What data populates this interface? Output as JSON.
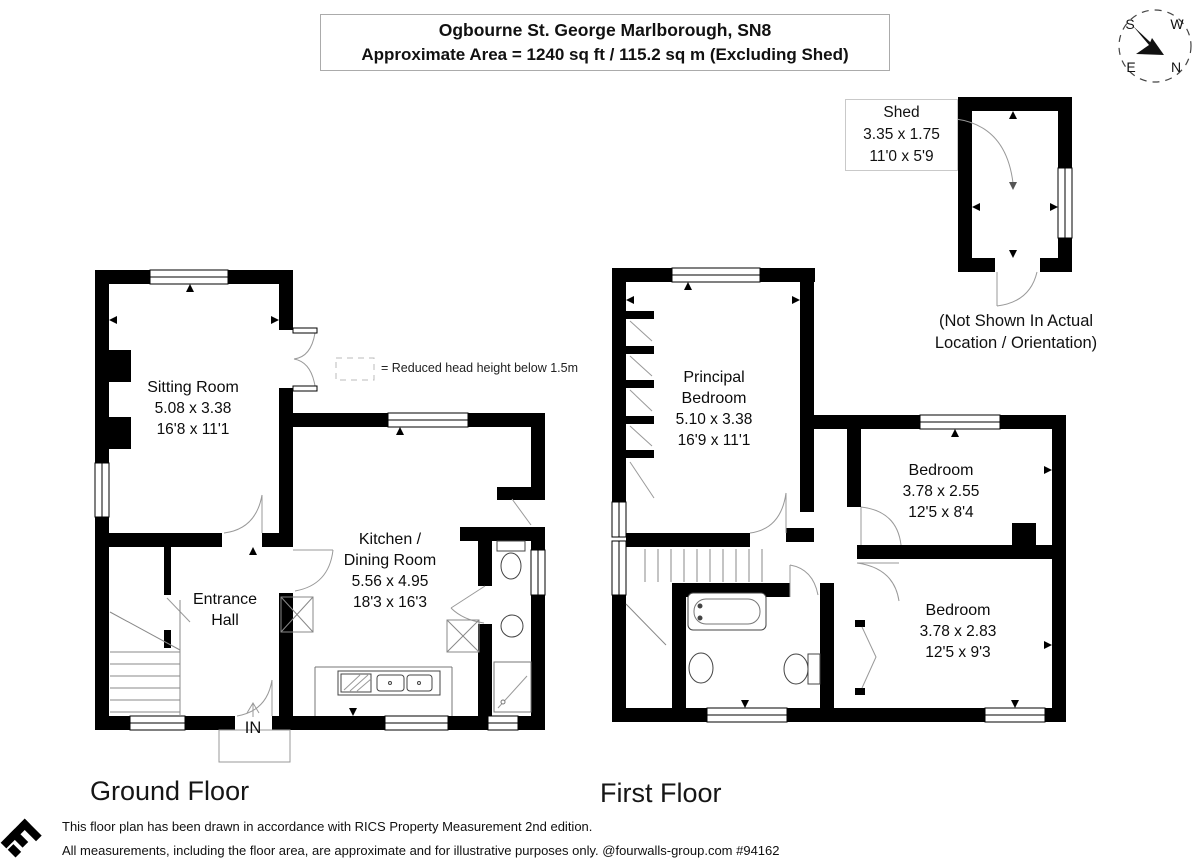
{
  "header": {
    "line1": "Ogbourne St. George Marlborough, SN8",
    "line2": "Approximate Area = 1240 sq ft / 115.2 sq m  (Excluding Shed)"
  },
  "compass": {
    "north": "N",
    "south": "S",
    "east": "E",
    "west": "W"
  },
  "shed": {
    "label": "Shed",
    "dims_metric": "3.35 x 1.75",
    "dims_imperial": "11'0 x 5'9",
    "note1": "(Not Shown In Actual",
    "note2": "Location / Orientation)"
  },
  "legend": {
    "reduced_head_height": "= Reduced head height below 1.5m"
  },
  "ground_floor": {
    "label": "Ground Floor",
    "sitting_room": {
      "name": "Sitting Room",
      "metric": "5.08 x 3.38",
      "imperial": "16'8 x 11'1"
    },
    "kitchen": {
      "name1": "Kitchen /",
      "name2": "Dining Room",
      "metric": "5.56 x 4.95",
      "imperial": "18'3 x 16'3"
    },
    "entrance_hall": {
      "name1": "Entrance",
      "name2": "Hall"
    },
    "entrance_marker": "IN"
  },
  "first_floor": {
    "label": "First Floor",
    "principal_bedroom": {
      "name1": "Principal",
      "name2": "Bedroom",
      "metric": "5.10 x 3.38",
      "imperial": "16'9 x 11'1"
    },
    "bedroom_1": {
      "name": "Bedroom",
      "metric": "3.78 x 2.55",
      "imperial": "12'5 x 8'4"
    },
    "bedroom_2": {
      "name": "Bedroom",
      "metric": "3.78 x 2.83",
      "imperial": "12'5 x 9'3"
    }
  },
  "footer": {
    "line1": "This floor plan has been drawn in accordance with RICS Property Measurement 2nd edition.",
    "line2": "All measurements, including the floor area, are approximate and for illustrative purposes only. @fourwalls-group.com #94162"
  }
}
